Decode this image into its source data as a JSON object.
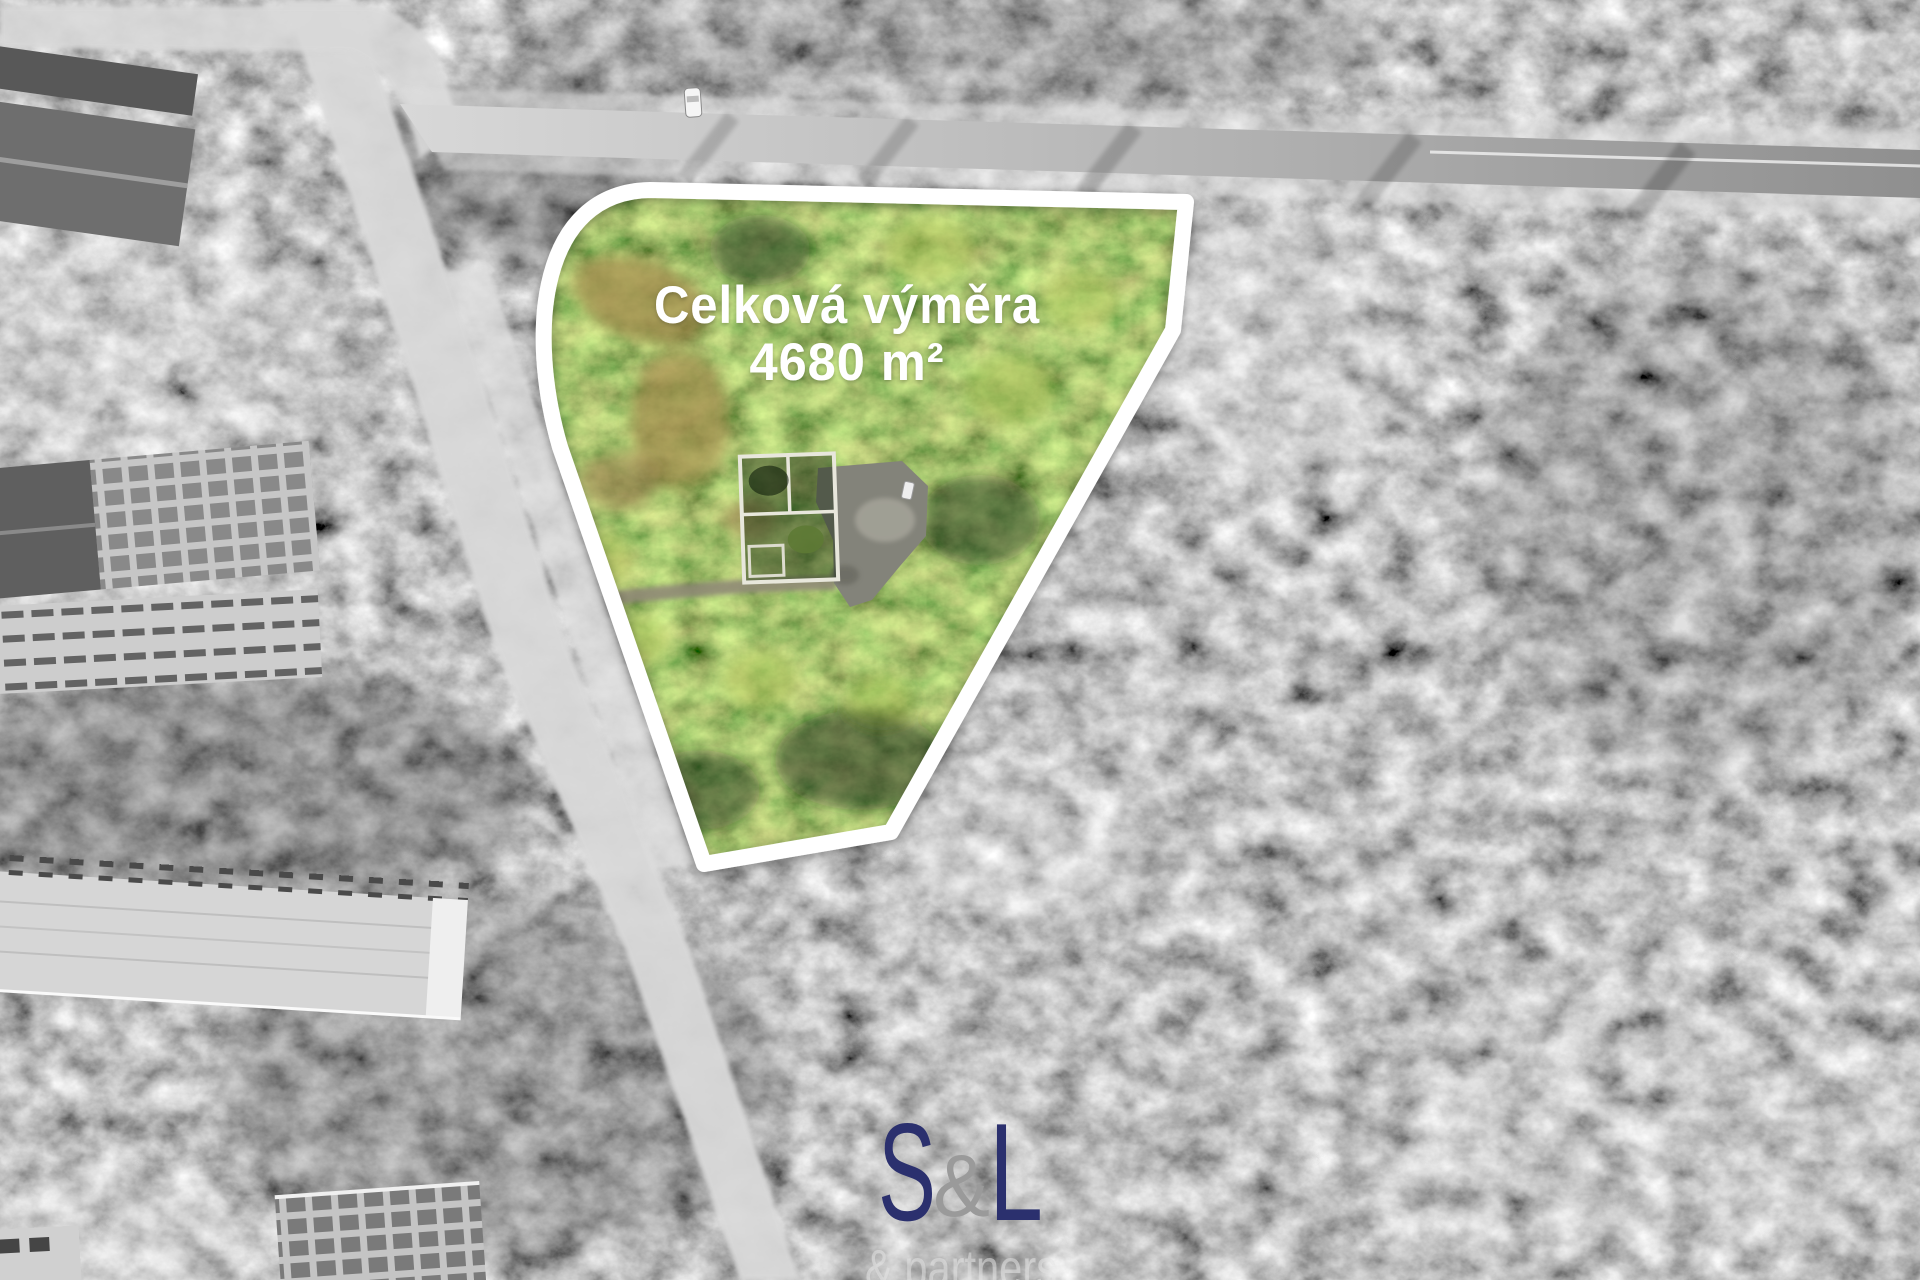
{
  "parcel": {
    "label_line1": "Celková výměra",
    "label_line2": "4680 m²",
    "area_value": "4680",
    "area_unit": "m²",
    "outline_color": "#ffffff"
  },
  "watermark": {
    "logo_s": "S",
    "logo_amp": "&",
    "logo_l": "L",
    "subtitle": "& partners",
    "logo_color": "#2b306e",
    "amp_color": "#9a9a9a",
    "subtitle_color": "#e4e4e4"
  }
}
